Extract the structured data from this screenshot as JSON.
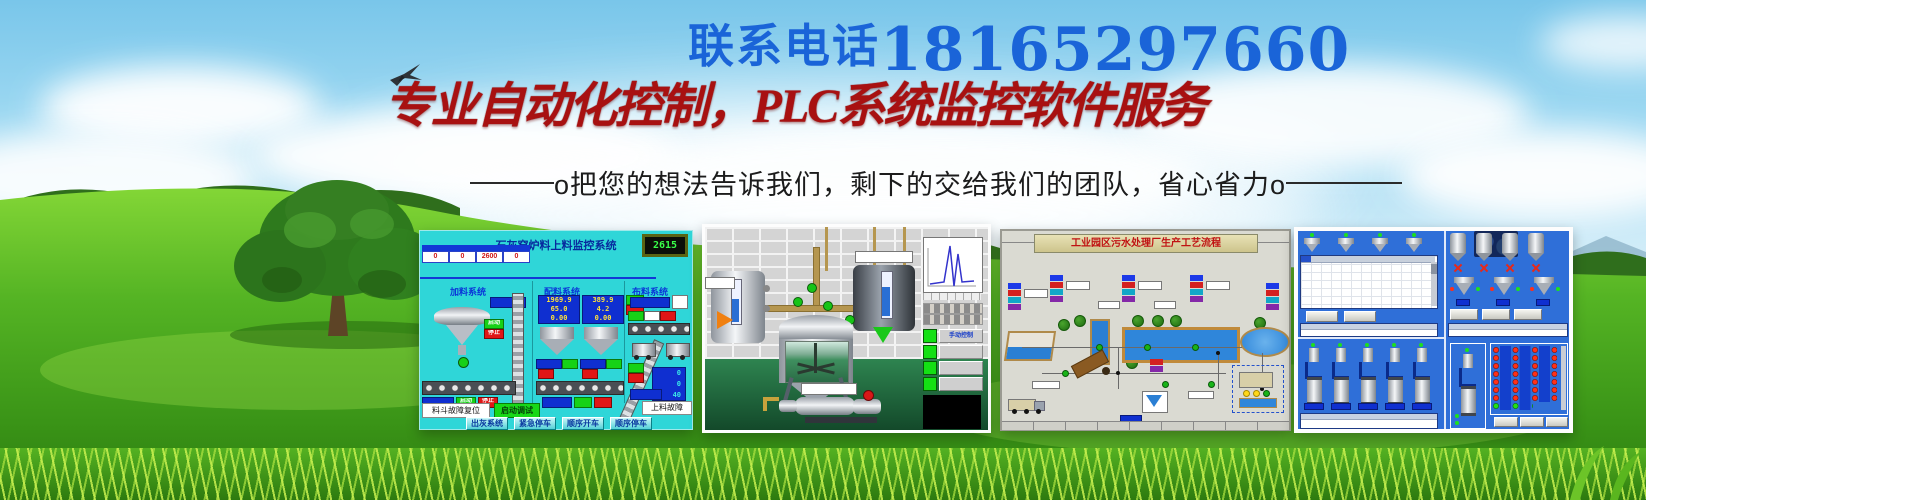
{
  "banner": {
    "phone_label": "联系电话",
    "phone_number": "18165297660",
    "headline": "专业自动化控制，PLC系统监控软件服务",
    "tagline": "o把您的想法告诉我们，剩下的交给我们的团队，省心省力o",
    "colors": {
      "phone_blue": "#1a64d8",
      "headline_red": "#a81111",
      "hmi_cyan": "#2fd6d8",
      "hmi_blue": "#2f6fd8",
      "grass_green": "#4fae1e",
      "sky_blue": "#79c6ea"
    }
  },
  "screens": {
    "lime_kiln": {
      "title": "石灰窑炉料上料监控系统",
      "lcd": "2615",
      "sections": [
        "加料系统",
        "配料系统",
        "布料系统"
      ],
      "table_values": [
        "0",
        "0",
        "2600",
        "0"
      ],
      "batch1": [
        "1969.9",
        "65.0",
        "0.00"
      ],
      "batch2": [
        "389.9",
        "4.2",
        "0.00"
      ],
      "chip_start": "启动",
      "chip_stop": "停止",
      "reset_button": "料斗故障复位",
      "debug_button": "启动调试",
      "fault_label": "上料故障",
      "bottom_buttons": [
        "出灰系统",
        "紧急停车",
        "顺序开车",
        "顺序停车"
      ],
      "cart_values": [
        "0",
        "0",
        "40"
      ]
    },
    "mixer_3d": {
      "panel_label": "手动控制"
    },
    "wastewater": {
      "title": "工业园区污水处理厂生产工艺流程"
    }
  }
}
